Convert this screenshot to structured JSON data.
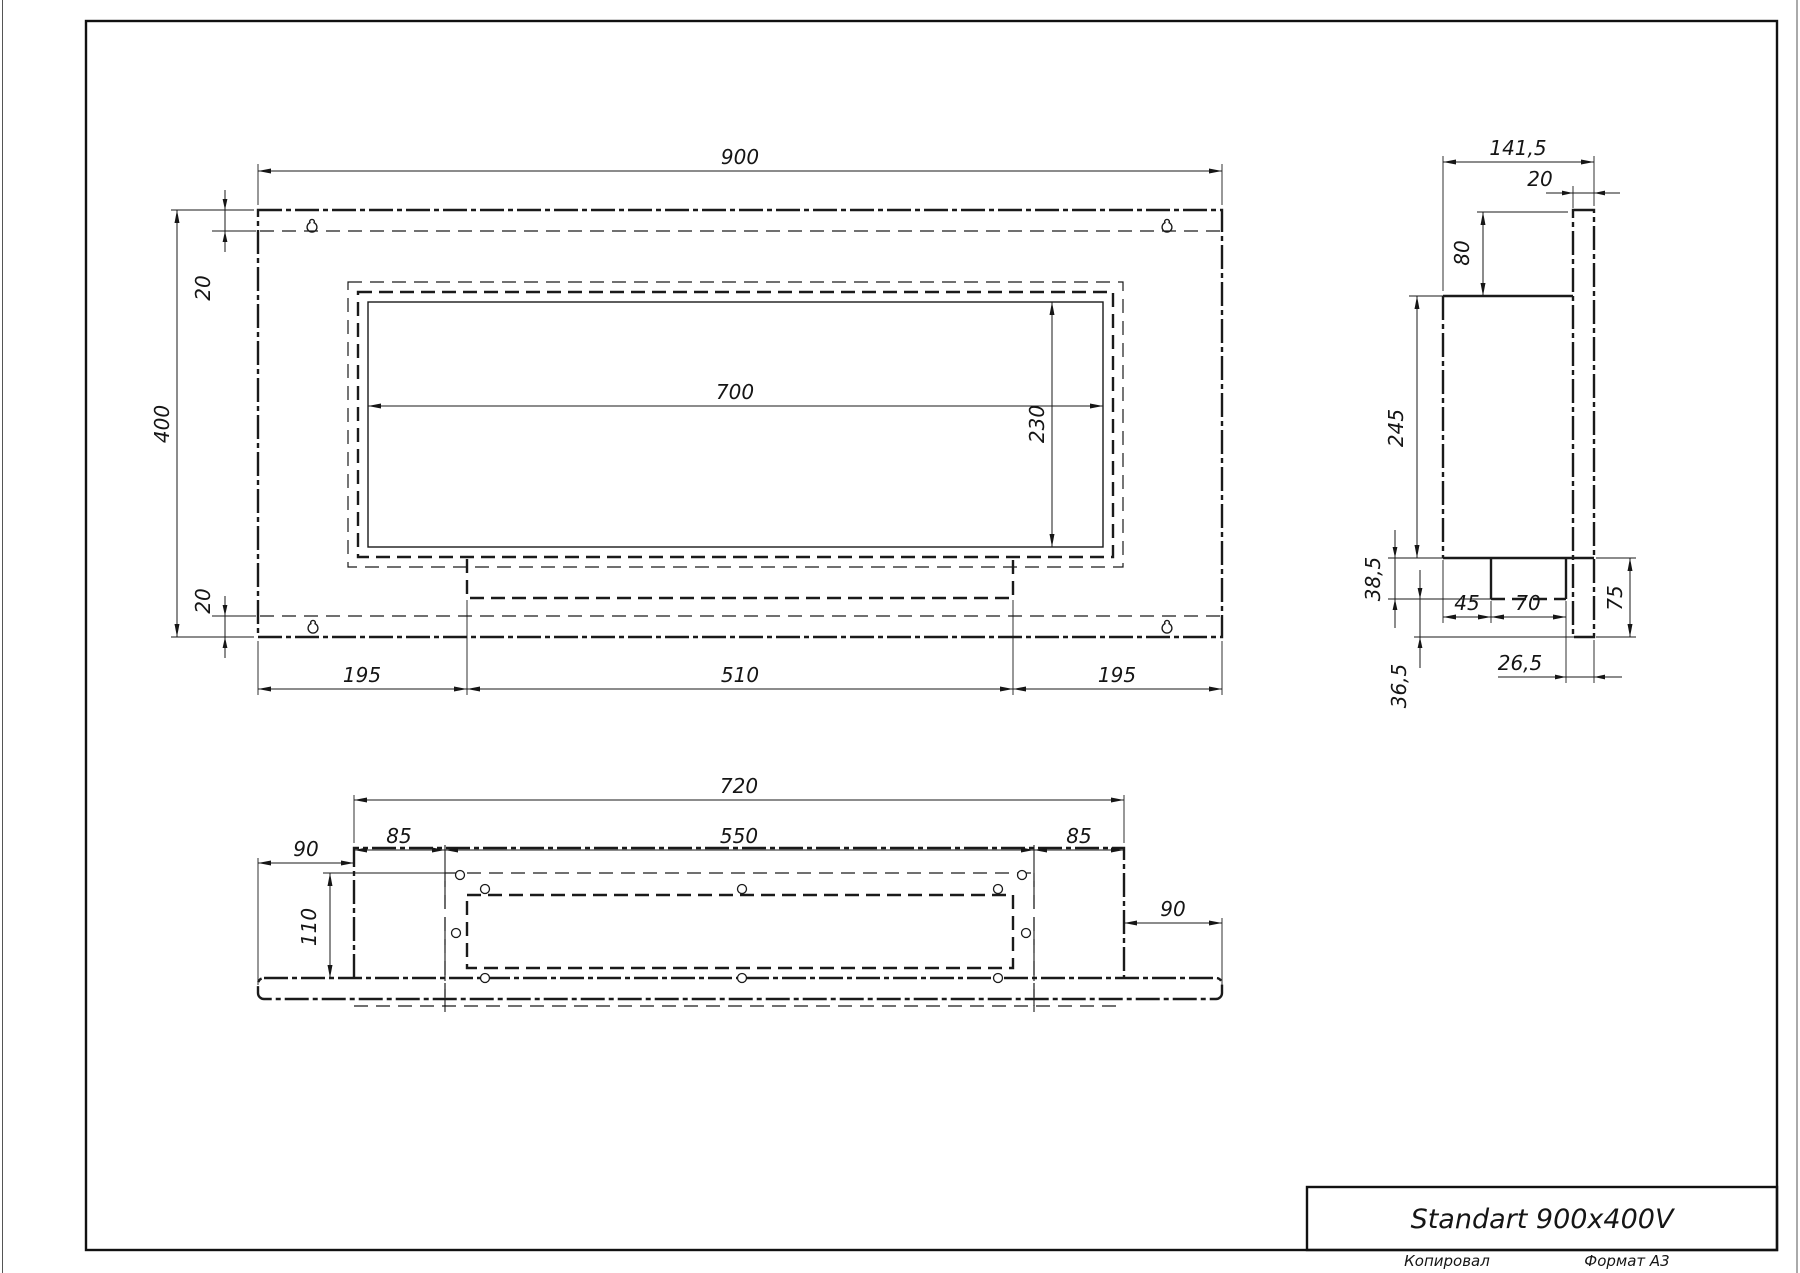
{
  "sheet": {
    "copied_label": "Копировал",
    "format_label": "Формат А3"
  },
  "title_block": {
    "model": "Standart 900x400V"
  },
  "dims": {
    "front_width": "900",
    "front_height": "400",
    "front_top_offset": "20",
    "front_bottom_offset": "20",
    "opening_width": "700",
    "opening_height": "230",
    "bottom_margin_left": "195",
    "burner_width": "510",
    "bottom_margin_right": "195",
    "side_depth": "141,5",
    "back_plate_thickness": "20",
    "top_inset": "80",
    "side_body_height": "245",
    "step_height": "38,5",
    "tray_offset": "45",
    "tray_width": "70",
    "tray_inset": "26,5",
    "lower_section_height": "36,5",
    "plate_lower_height": "75",
    "base_width": "720",
    "flange_length": "550",
    "flange_margin_left": "85",
    "flange_margin_right": "85",
    "plate_overhang_left": "90",
    "plate_overhang_right": "90",
    "base_depth": "110"
  },
  "icons": {
    "keyhole": "keyhole-hanger-icon"
  },
  "colors": {
    "line": "#1a1a1a",
    "paper": "#ffffff"
  }
}
